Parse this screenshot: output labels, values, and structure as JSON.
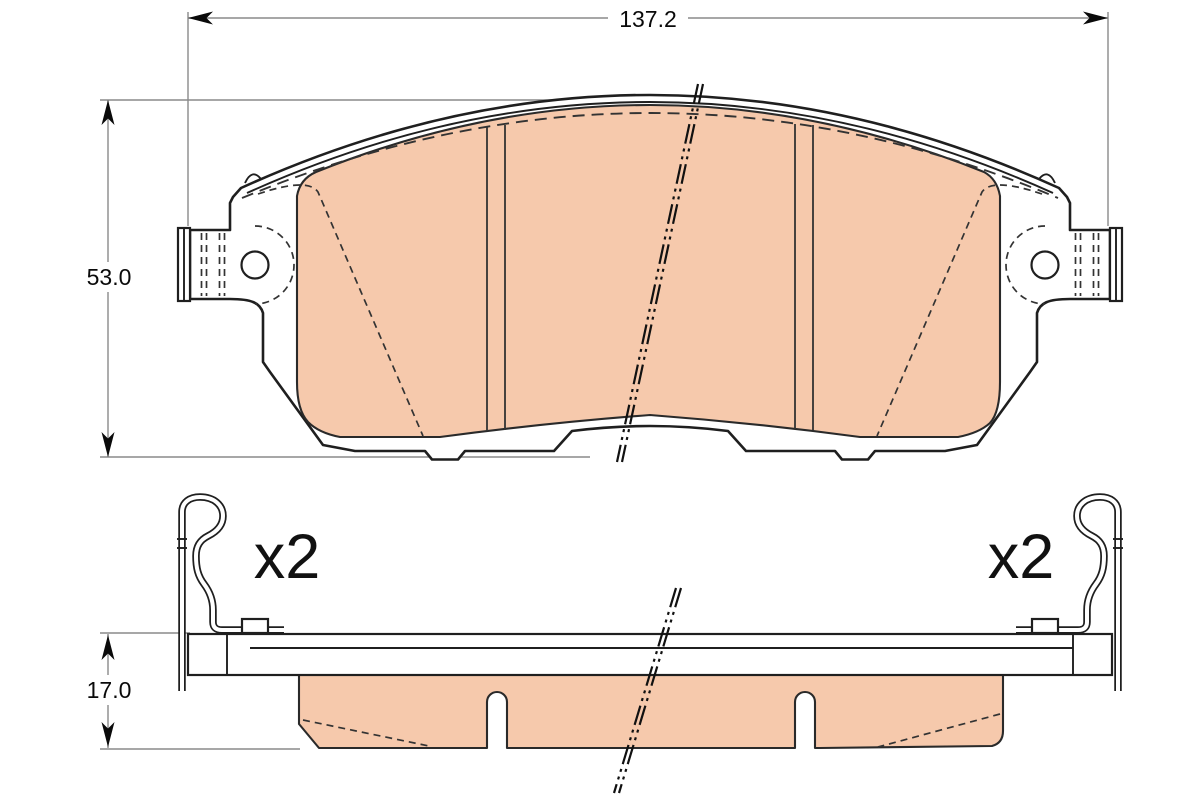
{
  "drawing": {
    "type": "technical-dimension-drawing",
    "subject": "disc-brake-pad-set",
    "views": {
      "top_view": "brake pad plan view with mounting ears, holes and friction material",
      "side_view": "brake pad edge view with backing plate, friction material and retaining spring clips"
    },
    "dimensions": {
      "width": {
        "label": "137.2"
      },
      "height": {
        "label": "53.0"
      },
      "thickness": {
        "label": "17.0"
      }
    },
    "quantity": {
      "left": {
        "label": "x2"
      },
      "right": {
        "label": "x2"
      }
    },
    "colors": {
      "friction_material": "#f6c9ac",
      "part_outline": "#1f1f1f",
      "dimension_lines": "#8a8a8a",
      "text": "#0a0a0a",
      "background": "#ffffff"
    }
  }
}
